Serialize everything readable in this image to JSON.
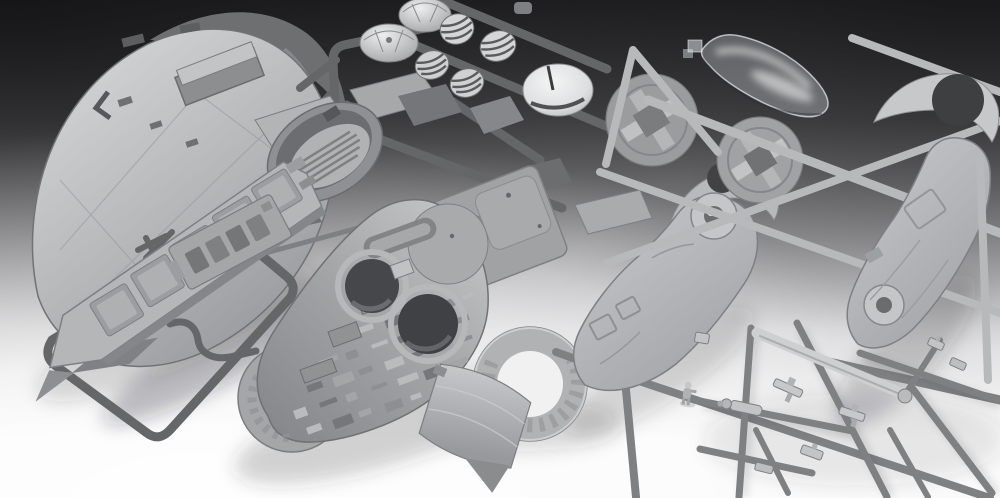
{
  "meta": {
    "type": "photograph",
    "width_px": 1000,
    "height_px": 498
  },
  "scene": {
    "description": "Studio photograph of an unassembled gray plastic scale-model spaceship kit: sprue frames holding hull shell halves, a long wing panel, a cockpit tub, ribbed engine cylinders and domes, round hub discs, ring-shaped side discs, a large greebled hull underside with two round engine openings, a transparent cockpit canopy, and a frame of small gun parts, lit bright from the lower left on a dark-to-white gradient backdrop.",
    "objects": [
      {
        "id": "nose-hull-shell",
        "label": "large rounded nose hull shell"
      },
      {
        "id": "cowl-arc",
        "label": "curved cowl strip beside nose shell"
      },
      {
        "id": "wing-panel",
        "label": "long wing panel with recessed plates"
      },
      {
        "id": "wing-sprue-frame",
        "label": "rounded sprue frame around wing"
      },
      {
        "id": "cockpit-tub",
        "label": "oval cockpit tub with ribbed floor"
      },
      {
        "id": "engine-domes",
        "label": "two small dome parts"
      },
      {
        "id": "engine-cylinders",
        "label": "four ribbed engine cylinders"
      },
      {
        "id": "radar-dish-dome",
        "label": "large glossy dome with slot"
      },
      {
        "id": "deck-plate",
        "label": "interior deck plate with rounded slots"
      },
      {
        "id": "main-hull-underside",
        "label": "hull underside with two round engine openings and greebled surface"
      },
      {
        "id": "side-ring-left",
        "label": "ring-shaped side disc, left"
      },
      {
        "id": "side-ring-bottom",
        "label": "ring-shaped side disc, bottom"
      },
      {
        "id": "curved-panel",
        "label": "curved rectangular hull panel"
      },
      {
        "id": "wing-disc-upper",
        "label": "round hub disc with cross ribs"
      },
      {
        "id": "wing-disc-lower",
        "label": "round hub disc with cross ribs"
      },
      {
        "id": "hull-side-center",
        "label": "boot-shaped hull side half with dome fitting"
      },
      {
        "id": "hull-side-right",
        "label": "boot-shaped hull side half with dome fitting"
      },
      {
        "id": "crescent-center",
        "label": "crescent cowl piece"
      },
      {
        "id": "crescent-right",
        "label": "crescent cowl piece with round cutout"
      },
      {
        "id": "canopy-clear",
        "label": "transparent cockpit canopy"
      },
      {
        "id": "hatch-plate",
        "label": "small hatch plate with ladder slots"
      },
      {
        "id": "small-parts-sprue",
        "label": "sprue frame of small gun and antenna parts"
      },
      {
        "id": "pilot-figure",
        "label": "tiny pilot figure part"
      },
      {
        "id": "runner-bars",
        "label": "plastic sprue runner bars"
      }
    ]
  },
  "palette": {
    "bg-top": "#262628",
    "bg-upper": "#545457",
    "bg-mid": "#9b9b9e",
    "bg-lower": "#dbdbdd",
    "bg-bottom": "#fafafa",
    "plastic-light": "#cdcfd1",
    "plastic-mid": "#aeb0b2",
    "plastic-base": "#9b9da0",
    "plastic-dark": "#7d7f82",
    "plastic-deep": "#606265",
    "runner-dark": "#646668",
    "runner-mid": "#7e8082",
    "runner-light": "#b7b9bb",
    "hole-dark": "#3f4144",
    "notch-dark": "#424244",
    "highlight": "#ffffff",
    "clear-part": "rgba(236,241,246,0.30)"
  }
}
